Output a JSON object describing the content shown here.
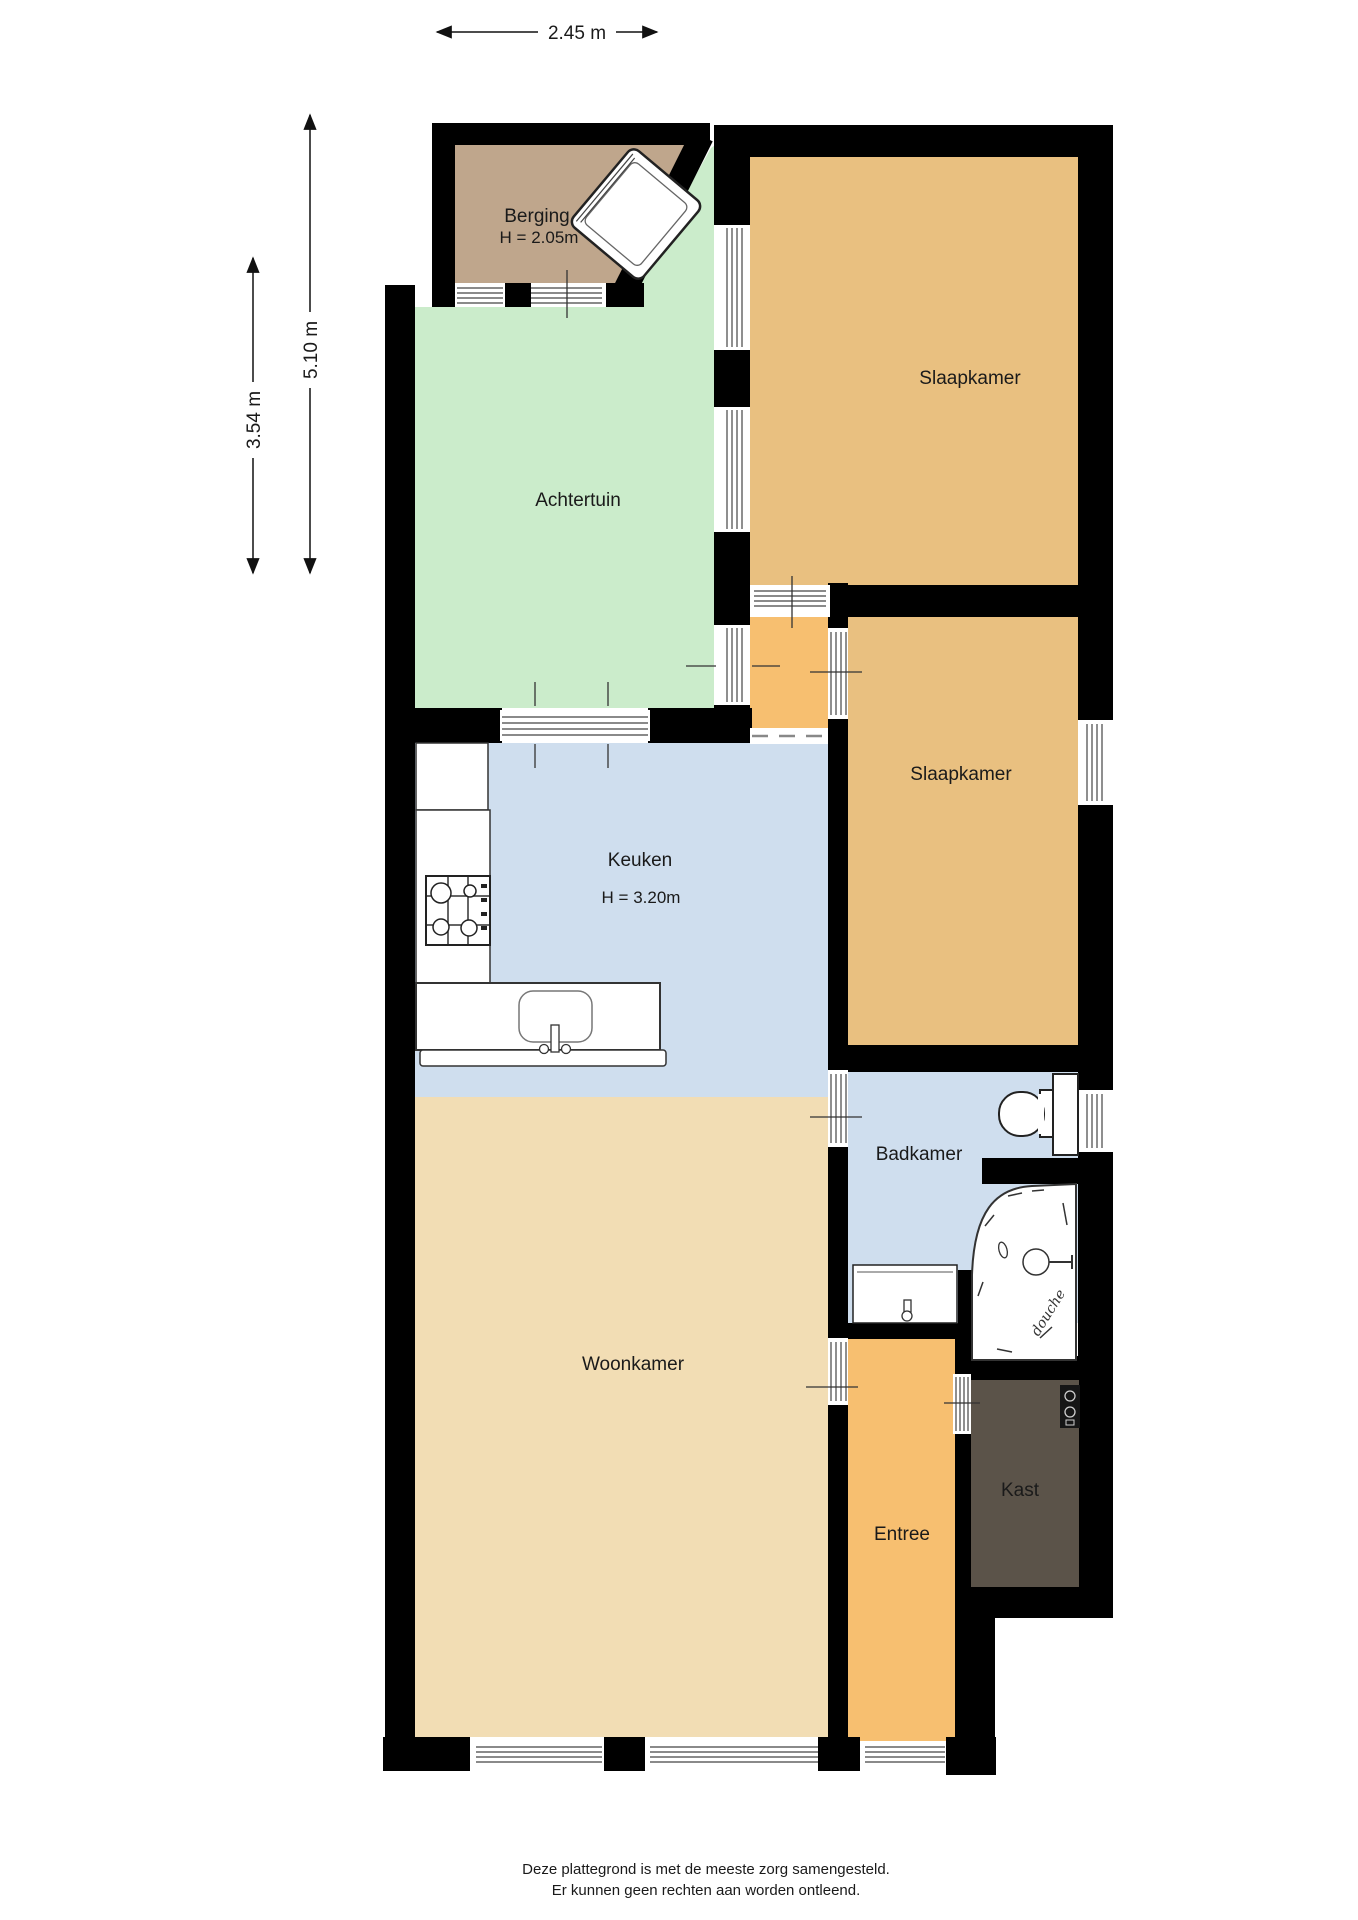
{
  "plan": {
    "rooms": {
      "berging": {
        "label": "Berging",
        "height_label": "H = 2.05m",
        "color": "#bfa68c"
      },
      "achtertuin": {
        "label": "Achtertuin",
        "color": "#cbeccb"
      },
      "slaapkamer1": {
        "label": "Slaapkamer",
        "color": "#e9c080"
      },
      "slaapkamer2": {
        "label": "Slaapkamer",
        "color": "#e9c080"
      },
      "hal": {
        "color": "#f7bf70"
      },
      "keuken": {
        "label": "Keuken",
        "height_label": "H = 3.20m",
        "color": "#cfdeee"
      },
      "badkamer": {
        "label": "Badkamer",
        "color": "#cfdeee"
      },
      "woonkamer": {
        "label": "Woonkamer",
        "color": "#f2ddb4"
      },
      "entree": {
        "label": "Entree",
        "color": "#f7bf70"
      },
      "kast": {
        "label": "Kast",
        "color": "#5b5349"
      }
    },
    "fixtures": {
      "shower_label": "douche"
    },
    "dimensions": {
      "top_width": "2.45 m",
      "left_outer_height": "5.10 m",
      "left_inner_height": "3.54 m"
    },
    "wall_color": "#000000",
    "disclaimer": {
      "line1": "Deze plattegrond is met de meeste zorg samengesteld.",
      "line2": "Er kunnen geen rechten aan worden ontleend."
    }
  }
}
